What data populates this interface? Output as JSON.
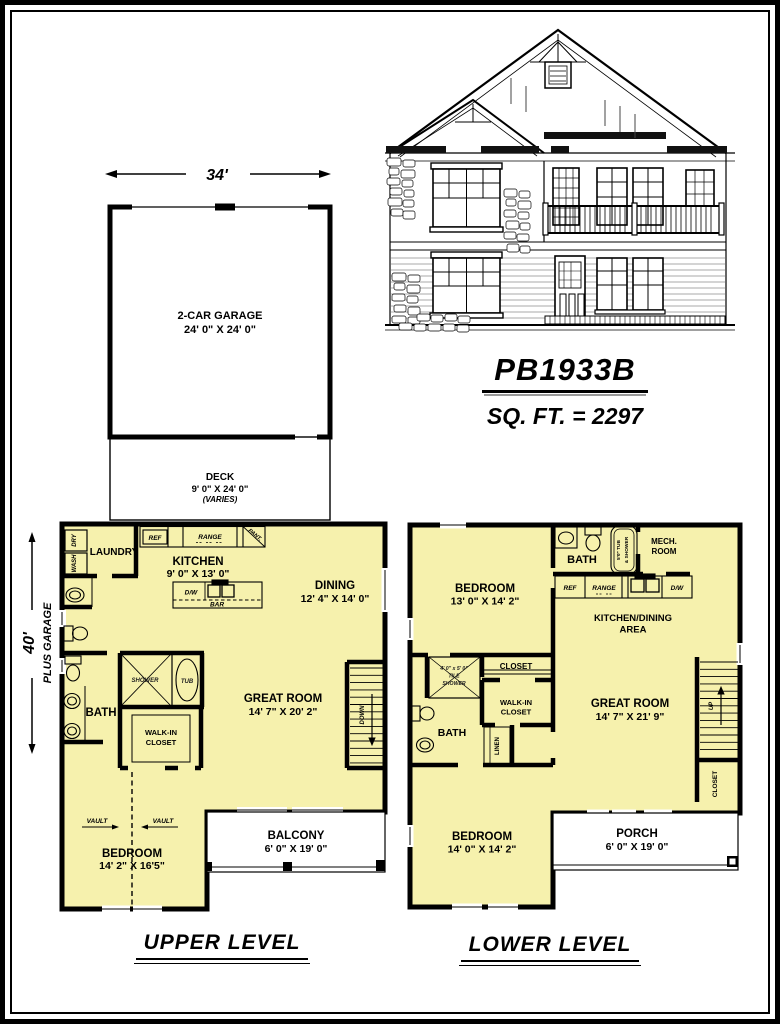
{
  "colors": {
    "room_fill": "#F6F1AD",
    "wall": "#000000",
    "paper": "#FFFFFF"
  },
  "title_block": {
    "plan_number": "PB1933B",
    "square_footage": "SQ. FT. = 2297"
  },
  "site": {
    "width_dim": "34'",
    "garage": {
      "name": "2-CAR GARAGE",
      "dims": "24' 0\" X 24' 0\""
    },
    "deck": {
      "name": "DECK",
      "dims": "9' 0\" X 24' 0\"",
      "note": "(VARIES)"
    },
    "height_dim": {
      "value": "40'",
      "note": "PLUS GARAGE"
    }
  },
  "upper_level": {
    "heading": "UPPER LEVEL",
    "rooms": {
      "laundry": {
        "name": "LAUNDRY"
      },
      "kitchen": {
        "name": "KITCHEN",
        "dims": "9' 0\" X 13' 0\""
      },
      "dining": {
        "name": "DINING",
        "dims": "12' 4\" X 14' 0\""
      },
      "great_room": {
        "name": "GREAT ROOM",
        "dims": "14' 7\" X 20' 2\""
      },
      "bath": {
        "name": "BATH"
      },
      "walk_in_closet": {
        "lines": [
          "WALK-IN",
          "CLOSET"
        ]
      },
      "bedroom": {
        "name": "BEDROOM",
        "dims": "14' 2\" X 16'5\""
      },
      "balcony": {
        "name": "BALCONY",
        "dims": "6' 0\" X 19' 0\""
      }
    },
    "fixtures": {
      "dryer": "DRY",
      "washer": "WASH",
      "fridge": "REF",
      "range": "RANGE",
      "pantry": "PANT.",
      "dishwasher": "D/W",
      "bar": "BAR",
      "shower": "SHOWER",
      "tub": "TUB",
      "stairs": "DOWN",
      "vault": "VAULT"
    }
  },
  "lower_level": {
    "heading": "LOWER LEVEL",
    "rooms": {
      "bedroom_upper": {
        "name": "BEDROOM",
        "dims": "13' 0\" X 14' 2\""
      },
      "bath_upper": {
        "name": "BATH"
      },
      "mech_room": {
        "lines": [
          "MECH.",
          "ROOM"
        ]
      },
      "kitchen_dining": {
        "lines": [
          "KITCHEN/DINING",
          "AREA"
        ]
      },
      "tile_shower": {
        "lines": [
          "4' 0\" x 5' 0\"",
          "TILE",
          "SHOWER"
        ]
      },
      "closet": {
        "name": "CLOSET"
      },
      "walk_in_closet": {
        "lines": [
          "WALK-IN",
          "CLOSET"
        ]
      },
      "linen": {
        "name": "LINEN"
      },
      "bath_lower": {
        "name": "BATH"
      },
      "great_room": {
        "name": "GREAT ROOM",
        "dims": "14' 7\" X 21' 9\""
      },
      "stair_closet": {
        "name": "CLOSET"
      },
      "bedroom_lower": {
        "name": "BEDROOM",
        "dims": "14' 0\" X 14' 2\""
      },
      "porch": {
        "name": "PORCH",
        "dims": "6' 0\" X 19' 0\""
      }
    },
    "fixtures": {
      "fridge": "REF",
      "range": "RANGE",
      "dishwasher": "D/W",
      "tub_shower": {
        "lines": [
          "5'0\" TUB",
          "& SHOWER"
        ]
      },
      "stairs": "UP"
    }
  }
}
